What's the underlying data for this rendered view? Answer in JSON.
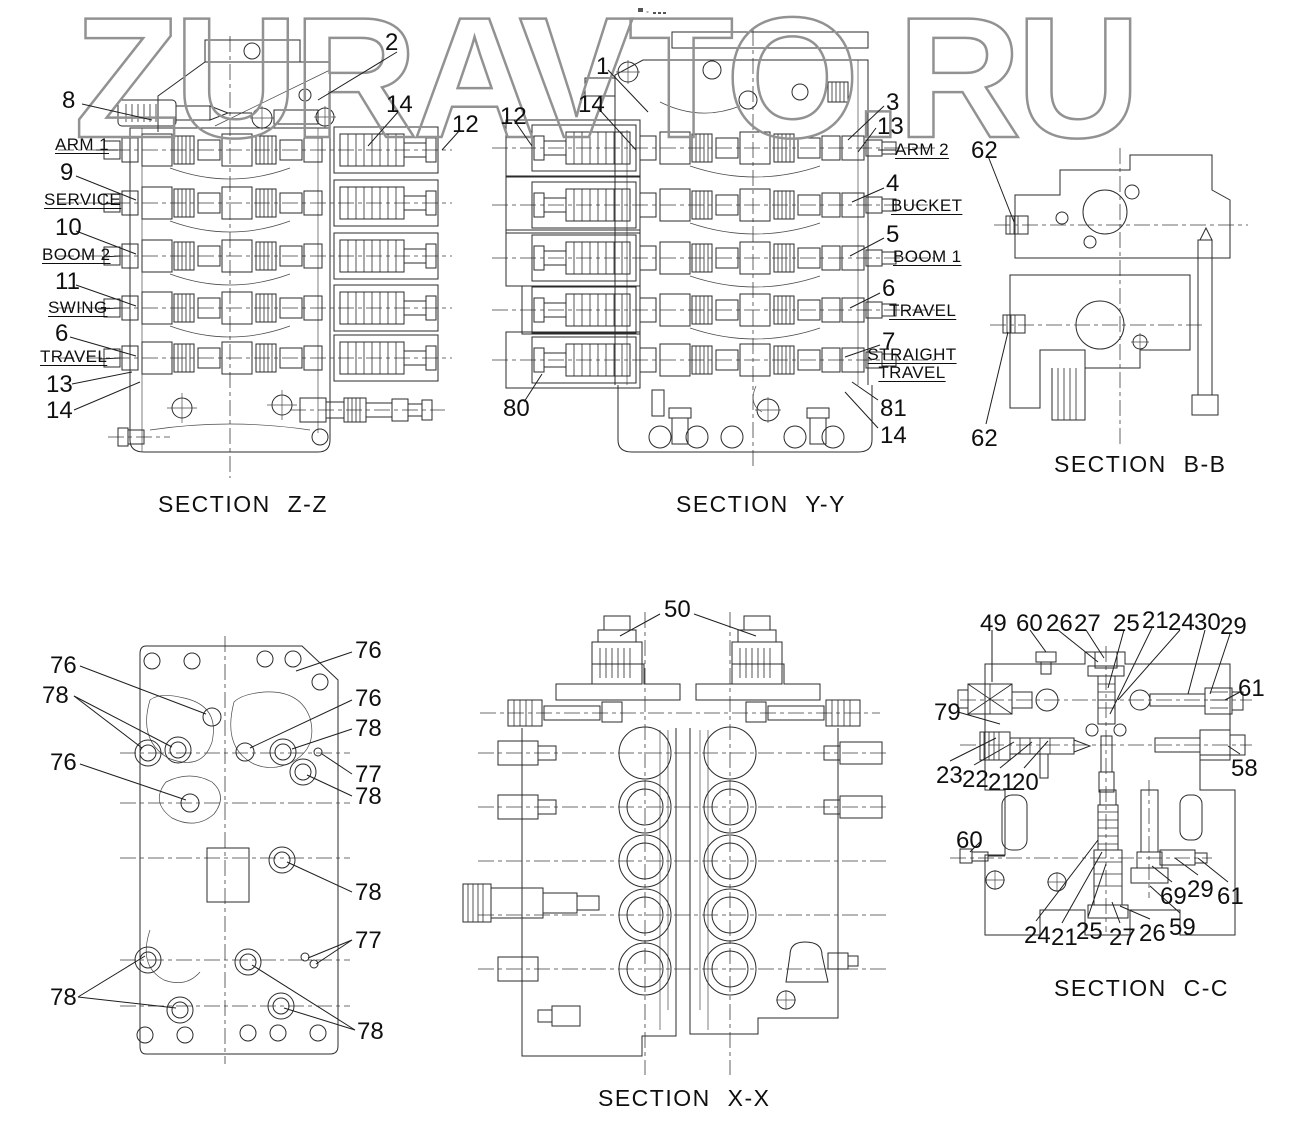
{
  "watermark": {
    "text": "ZURAVTO.RU"
  },
  "sections": {
    "zz": {
      "caption": "SECTION Z-Z",
      "top": [
        "2",
        "8",
        "14",
        "12"
      ],
      "left": [
        "ARM 1",
        "9",
        "SERVICE",
        "10",
        "BOOM 2",
        "11",
        "SWING",
        "6",
        "TRAVEL",
        "13",
        "14"
      ]
    },
    "yy": {
      "caption": "SECTION Y-Y",
      "top": [
        "12",
        "14",
        "1"
      ],
      "right": [
        "3",
        "13",
        "ARM 2",
        "4",
        "BUCKET",
        "5",
        "BOOM 1",
        "6",
        "TRAVEL",
        "7",
        "STRAIGHT TRAVEL",
        "81",
        "14"
      ],
      "left": [
        "80"
      ]
    },
    "bb": {
      "caption": "SECTION B-B",
      "callouts": [
        "62",
        "62"
      ]
    },
    "plate": {
      "left": [
        "76",
        "78",
        "76",
        "78"
      ],
      "right": [
        "76",
        "76",
        "78",
        "77",
        "78",
        "78",
        "77",
        "78"
      ]
    },
    "xx": {
      "caption": "SECTION X-X",
      "callouts": [
        "50"
      ]
    },
    "cc": {
      "caption": "SECTION C-C",
      "top": [
        "49",
        "60",
        "26",
        "27",
        "25",
        "21",
        "24",
        "30",
        "29"
      ],
      "right_upper": "61",
      "left_upper": "79",
      "lower_left": [
        "23",
        "22",
        "21",
        "20"
      ],
      "right_mid": "58",
      "left_mid": "60",
      "bottom": [
        "24",
        "21",
        "25",
        "27",
        "26"
      ],
      "right_lower": [
        "69",
        "29",
        "61",
        "59"
      ]
    }
  },
  "colors": {
    "line": "#2b2b2b",
    "watermark": "#929292",
    "background": "#ffffff"
  }
}
